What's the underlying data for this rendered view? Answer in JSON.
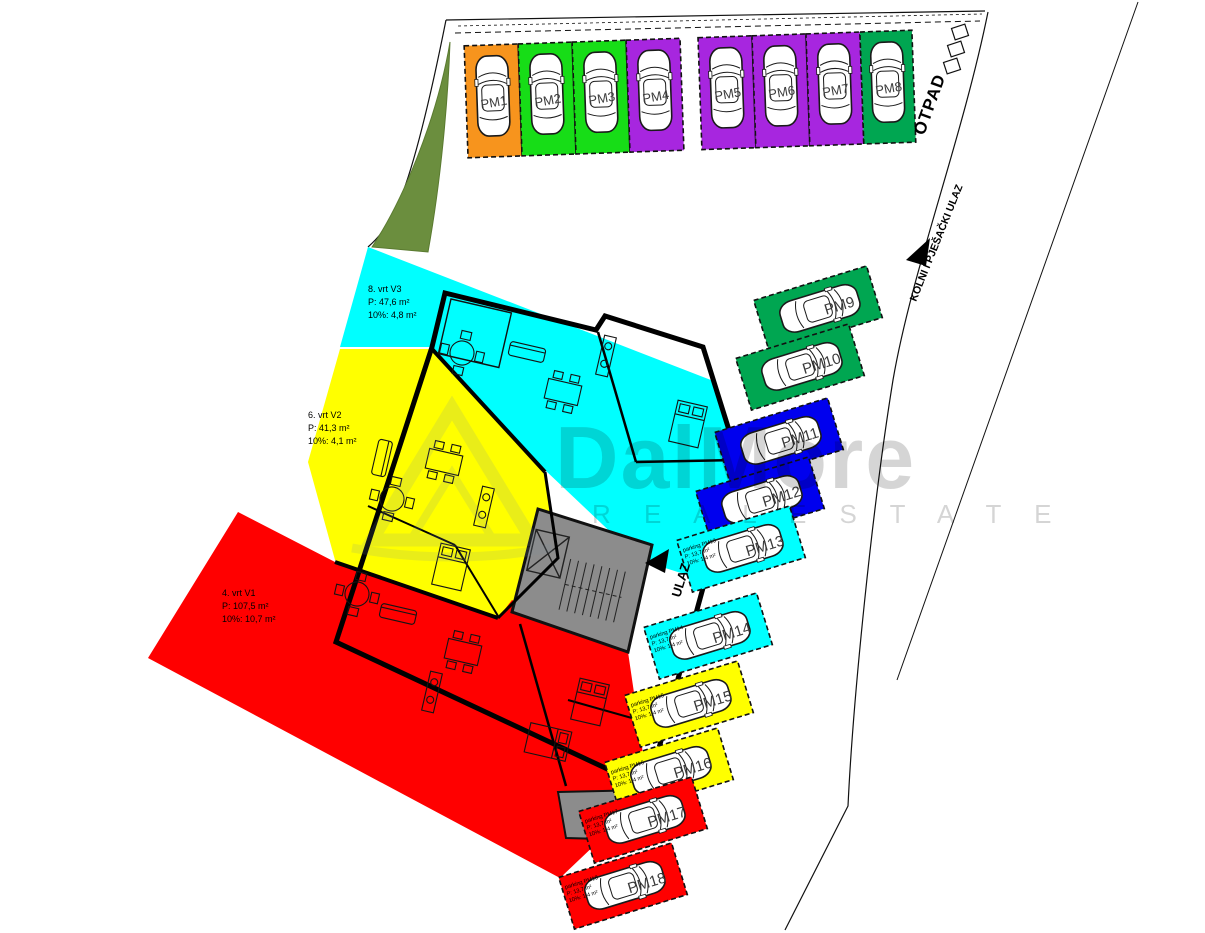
{
  "plan": {
    "otpad": "OTPAD",
    "kolni_pjesacki": "KOLNI I PJEŠAČKI ULAZ",
    "ulaz": "ULAZ"
  },
  "watermark": {
    "brand": "DalMore",
    "tagline": "R E A L   E S T A T E"
  },
  "colors": {
    "garden_v3": "#00FFFF",
    "garden_v2": "#FFFF00",
    "garden_v1": "#FF0000",
    "core_gray": "#8c8c8c",
    "grass_green": "#6b8e3e"
  },
  "gardens": [
    {
      "name": "vrt-v3",
      "color": "#00FFFF",
      "line1": "8. vrt V3",
      "line2": "P:    47,6 m²",
      "line3": "10%: 4,8 m²"
    },
    {
      "name": "vrt-v2",
      "color": "#FFFF00",
      "line1": "6. vrt V2",
      "line2": "P:    41,3 m²",
      "line3": "10%: 4,1 m²"
    },
    {
      "name": "vrt-v1",
      "color": "#FF0000",
      "line1": "4. vrt V1",
      "line2": "P:    107,5 m²",
      "line3": "10%: 10,7 m²"
    }
  ],
  "parking_row": [
    {
      "label": "PM1",
      "color": "#F7941D"
    },
    {
      "label": "PM2",
      "color": "#17DD17"
    },
    {
      "label": "PM3",
      "color": "#17DD17"
    },
    {
      "label": "PM4",
      "color": "#A726DF"
    },
    {
      "label": "PM5",
      "color": "#A726DF"
    },
    {
      "label": "PM6",
      "color": "#A726DF"
    },
    {
      "label": "PM7",
      "color": "#A726DF"
    },
    {
      "label": "PM8",
      "color": "#00A651"
    }
  ],
  "parking_column": [
    {
      "label": "PM9",
      "color": "#00A651"
    },
    {
      "label": "PM10",
      "color": "#00A651"
    },
    {
      "label": "PM11",
      "color": "#0000EE"
    },
    {
      "label": "PM12",
      "color": "#0000EE"
    },
    {
      "label": "PM13",
      "color": "#00FFFF",
      "note1": "parking PM13",
      "note2": "P:   13,7 m²",
      "note3": "10%: 1,4 m²"
    },
    {
      "label": "PM14",
      "color": "#00FFFF",
      "note1": "parking PM14",
      "note2": "P:   13,7 m²",
      "note3": "10%: 1,4 m²"
    },
    {
      "label": "PM15",
      "color": "#FFFF00",
      "note1": "parking PM15",
      "note2": "P:   13,7 m²",
      "note3": "10%: 1,4 m²"
    },
    {
      "label": "PM16",
      "color": "#FFFF00",
      "note1": "parking PM16",
      "note2": "P:   13,7 m²",
      "note3": "10%: 1,4 m²"
    },
    {
      "label": "PM17",
      "color": "#FF0000",
      "note1": "parking PM17",
      "note2": "P:   13,7 m²",
      "note3": "10%: 1,4 m²"
    },
    {
      "label": "PM18",
      "color": "#FF0000",
      "note1": "parking PM18",
      "note2": "P:   13,7 m²",
      "note3": "10%: 1,4 m²"
    }
  ]
}
